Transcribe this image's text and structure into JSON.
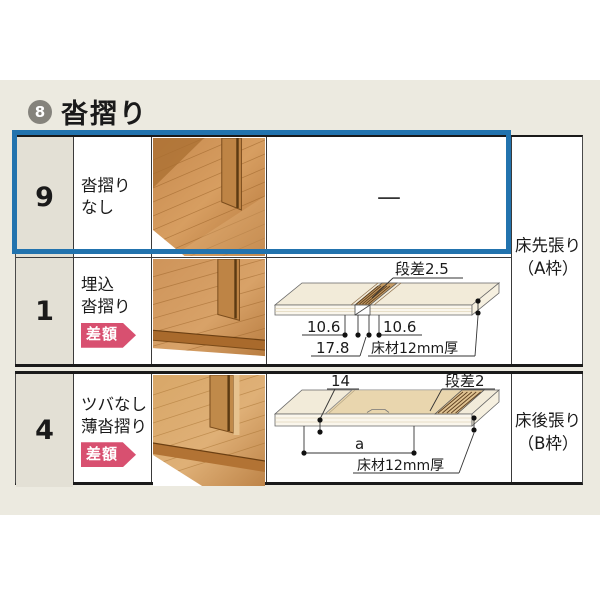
{
  "header": {
    "index_number": "8",
    "title": "沓摺り"
  },
  "table": {
    "rows": [
      {
        "num": "9",
        "name_line1": "沓摺り",
        "name_line2": "なし",
        "diagram_placeholder": "—"
      },
      {
        "num": "1",
        "name_line1": "埋込",
        "name_line2": "沓摺り",
        "badge": "差額"
      },
      {
        "num": "4",
        "name_line1": "ツバなし",
        "name_line2": "薄沓摺り",
        "badge": "差額"
      }
    ],
    "section_a_label": {
      "line1": "床先張り",
      "line2": "（A枠）"
    },
    "section_b_label": {
      "line1": "床後張り",
      "line2": "（B枠）"
    }
  },
  "diagram_a": {
    "step_label": "段差2.5",
    "dim_left": "10.6",
    "dim_right": "10.6",
    "dim_total": "17.8",
    "material_label": "床材12mm厚"
  },
  "diagram_b": {
    "edge_height": "14",
    "step_label": "段差2",
    "span_label": "a",
    "material_label": "床材12mm厚"
  },
  "colors": {
    "page_band": "#ECEAE0",
    "number_column": "#E3E0D5",
    "highlight_blue": "#2273AE",
    "badge_pink": "#D85070",
    "header_circle_gray": "#85837C",
    "table_border": "#1A1A1A"
  }
}
